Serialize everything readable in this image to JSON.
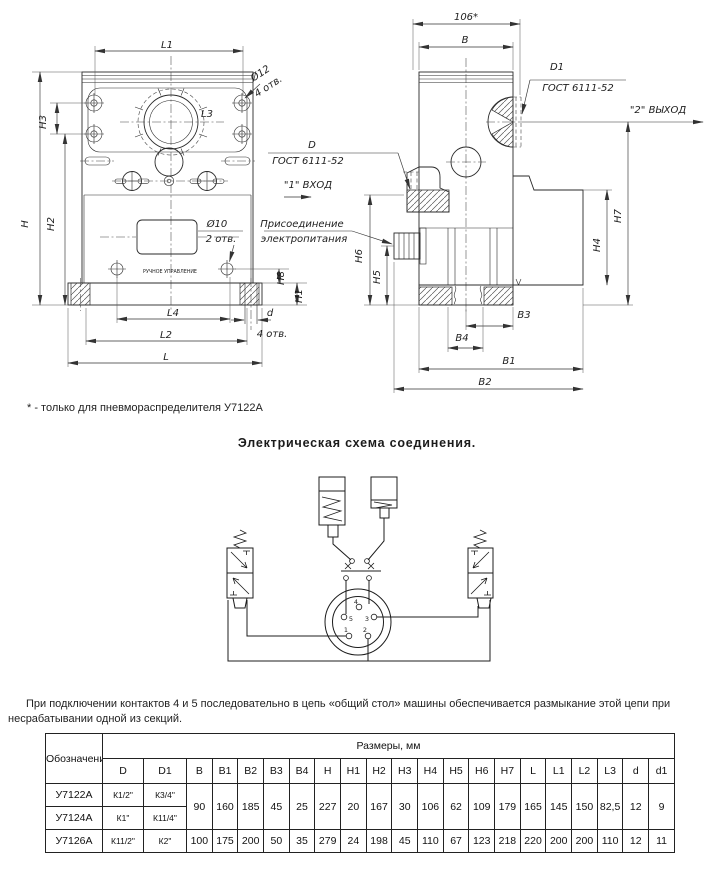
{
  "page": {
    "note": "* - только для пневмораспределителя У7122А",
    "schematic_title": "Электрическая схема соединения.",
    "paragraph": "При подключении контактов 4 и 5 последовательно в цепь «общий стол» машины обеспечивается размыкание этой цепи при несрабатывании одной из секций."
  },
  "drawing_labels": [
    {
      "svg": "d",
      "t": "L1",
      "x": 167,
      "y": 48
    },
    {
      "svg": "d",
      "t": "Ø12",
      "x": 262,
      "y": 76,
      "r": -33
    },
    {
      "svg": "d",
      "t": "4 отв.",
      "x": 270,
      "y": 89,
      "r": -33
    },
    {
      "svg": "d",
      "t": "L3",
      "x": 207,
      "y": 117
    },
    {
      "svg": "d",
      "t": "H3",
      "x": 46,
      "y": 122,
      "r": -90
    },
    {
      "svg": "d",
      "t": "H",
      "x": 28,
      "y": 224,
      "r": -90
    },
    {
      "svg": "d",
      "t": "H2",
      "x": 54,
      "y": 224,
      "r": -90
    },
    {
      "svg": "d",
      "t": "Ø10",
      "x": 217,
      "y": 227
    },
    {
      "svg": "d",
      "t": "2 отв.",
      "x": 221,
      "y": 242
    },
    {
      "svg": "d",
      "t": "РУЧНОЕ УПРАВЛЕНИЕ",
      "x": 170,
      "y": 273,
      "f": 4.8,
      "i": 0
    },
    {
      "svg": "d",
      "t": "H8",
      "x": 284,
      "y": 278,
      "r": -90
    },
    {
      "svg": "d",
      "t": "H1",
      "x": 302,
      "y": 296,
      "r": -90
    },
    {
      "svg": "d",
      "t": "L4",
      "x": 173,
      "y": 316
    },
    {
      "svg": "d",
      "t": "d",
      "x": 270,
      "y": 316
    },
    {
      "svg": "d",
      "t": "L2",
      "x": 166,
      "y": 338
    },
    {
      "svg": "d",
      "t": "4 отв.",
      "x": 272,
      "y": 337
    },
    {
      "svg": "d",
      "t": "L",
      "x": 166,
      "y": 360
    },
    {
      "svg": "d",
      "t": "106*",
      "x": 466,
      "y": 20
    },
    {
      "svg": "d",
      "t": "B",
      "x": 465,
      "y": 43
    },
    {
      "svg": "d",
      "t": "D1",
      "x": 557,
      "y": 70
    },
    {
      "svg": "d",
      "t": "ГОСТ 6111-52",
      "x": 578,
      "y": 91
    },
    {
      "svg": "d",
      "t": "\"2\" ВЫХОД",
      "x": 658,
      "y": 113
    },
    {
      "svg": "d",
      "t": "D",
      "x": 312,
      "y": 148
    },
    {
      "svg": "d",
      "t": "ГОСТ 6111-52",
      "x": 308,
      "y": 164
    },
    {
      "svg": "d",
      "t": "\"1\" ВХОД",
      "x": 308,
      "y": 188
    },
    {
      "svg": "d",
      "t": "Присоединение",
      "x": 302,
      "y": 227
    },
    {
      "svg": "d",
      "t": "электропитания",
      "x": 304,
      "y": 242
    },
    {
      "svg": "d",
      "t": "H6",
      "x": 362,
      "y": 256,
      "r": -90
    },
    {
      "svg": "d",
      "t": "H5",
      "x": 380,
      "y": 277,
      "r": -90
    },
    {
      "svg": "d",
      "t": "H7",
      "x": 621,
      "y": 216,
      "r": -90
    },
    {
      "svg": "d",
      "t": "H4",
      "x": 600,
      "y": 245,
      "r": -90
    },
    {
      "svg": "d",
      "t": "B3",
      "x": 524,
      "y": 318
    },
    {
      "svg": "d",
      "t": "B4",
      "x": 462,
      "y": 341
    },
    {
      "svg": "d",
      "t": "B1",
      "x": 509,
      "y": 364
    },
    {
      "svg": "d",
      "t": "B2",
      "x": 485,
      "y": 385
    },
    {
      "svg": "s",
      "t": "5",
      "x": 351,
      "y": 621,
      "f": 6.5,
      "i": 0
    },
    {
      "svg": "s",
      "t": "4",
      "x": 356,
      "y": 604,
      "f": 6.5,
      "i": 0
    },
    {
      "svg": "s",
      "t": "3",
      "x": 367,
      "y": 621,
      "f": 6.5,
      "i": 0
    },
    {
      "svg": "s",
      "t": "1",
      "x": 346,
      "y": 632,
      "f": 6.5,
      "i": 0
    },
    {
      "svg": "s",
      "t": "2",
      "x": 365,
      "y": 632,
      "f": 6.5,
      "i": 0
    }
  ],
  "table": {
    "group_header": "Обозначение",
    "sizes_header": "Размеры, мм",
    "columns": [
      "D",
      "D1",
      "B",
      "B1",
      "B2",
      "B3",
      "B4",
      "H",
      "H1",
      "H2",
      "H3",
      "H4",
      "H5",
      "H6",
      "H7",
      "L",
      "L1",
      "L2",
      "L3",
      "d",
      "d1"
    ],
    "shared_values": [
      "90",
      "160",
      "185",
      "45",
      "25",
      "227",
      "20",
      "167",
      "30",
      "106",
      "62",
      "109",
      "179",
      "165",
      "145",
      "150",
      "82,5",
      "12",
      "9"
    ],
    "rows": [
      {
        "name": "У7122А",
        "d": "К1/2\"",
        "d1": "К3/4\""
      },
      {
        "name": "У7124А",
        "d": "К1\"",
        "d1": "К11/4\""
      },
      {
        "name": "У7126А",
        "d": "К11/2\"",
        "d1": "К2\"",
        "values": [
          "100",
          "175",
          "200",
          "50",
          "35",
          "279",
          "24",
          "198",
          "45",
          "110",
          "67",
          "123",
          "218",
          "220",
          "200",
          "200",
          "110",
          "12",
          "11"
        ]
      }
    ]
  }
}
